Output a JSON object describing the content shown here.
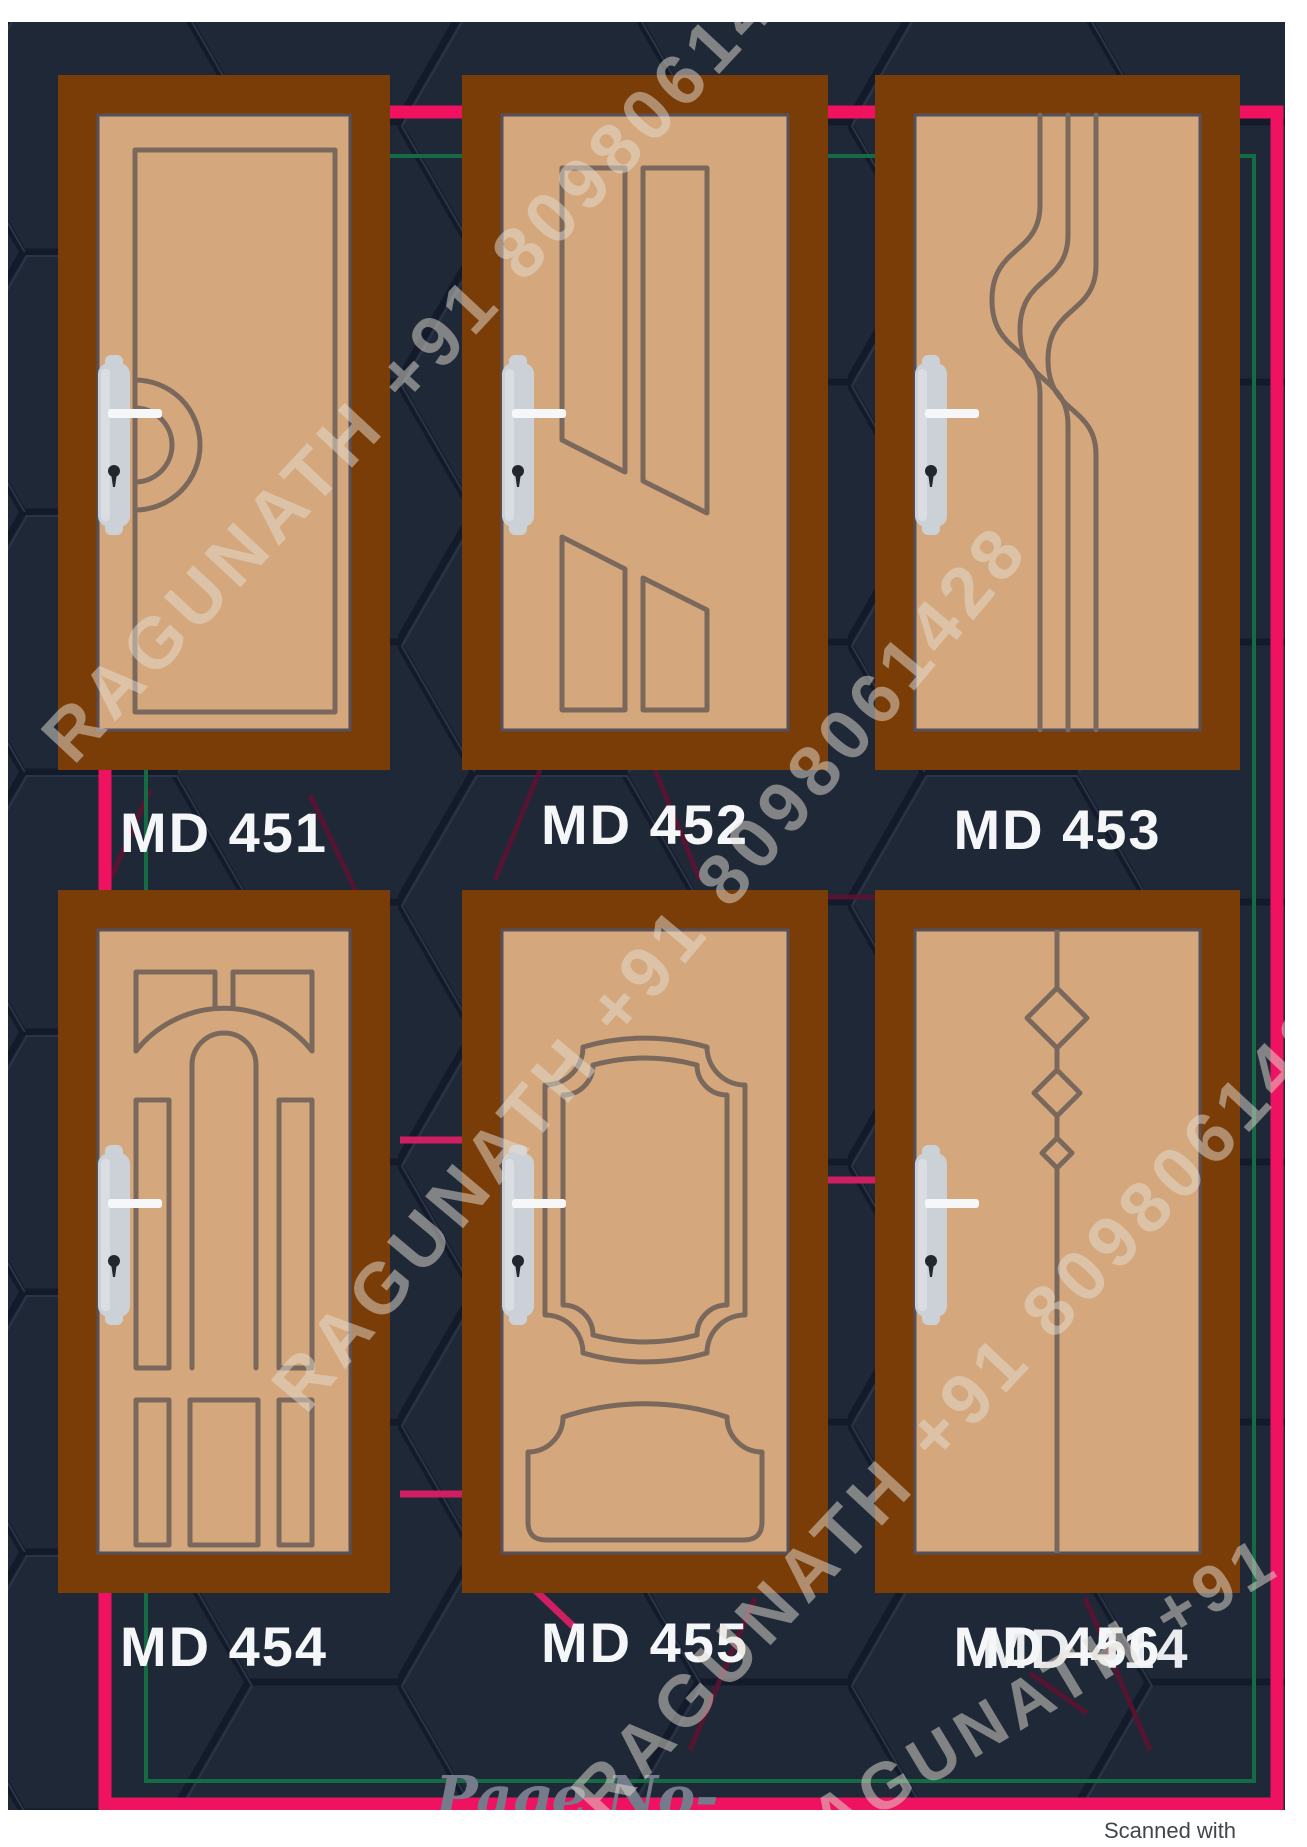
{
  "document": {
    "page_number_label": "Page No-77",
    "scanner_credit": "Scanned with CamScanner",
    "watermark_text": "RAGUNATH +91 8098061428"
  },
  "catalog": {
    "items": [
      {
        "code": "MD 451"
      },
      {
        "code": "MD 452"
      },
      {
        "code": "MD 453"
      },
      {
        "code": "MD 454"
      },
      {
        "code": "MD 455"
      },
      {
        "code": "MD 456",
        "ghost_code": "MD 414"
      }
    ]
  },
  "colors": {
    "background_navy": "#1f2837",
    "border_pink": "#ee1261",
    "border_green": "#156b44",
    "door_frame_brown": "#7a3d08",
    "door_panel_tan": "#d4a87c",
    "design_line": "#7b685c",
    "label_text": "#f5f6f8",
    "accent_pink_line": "#cf1f63"
  }
}
